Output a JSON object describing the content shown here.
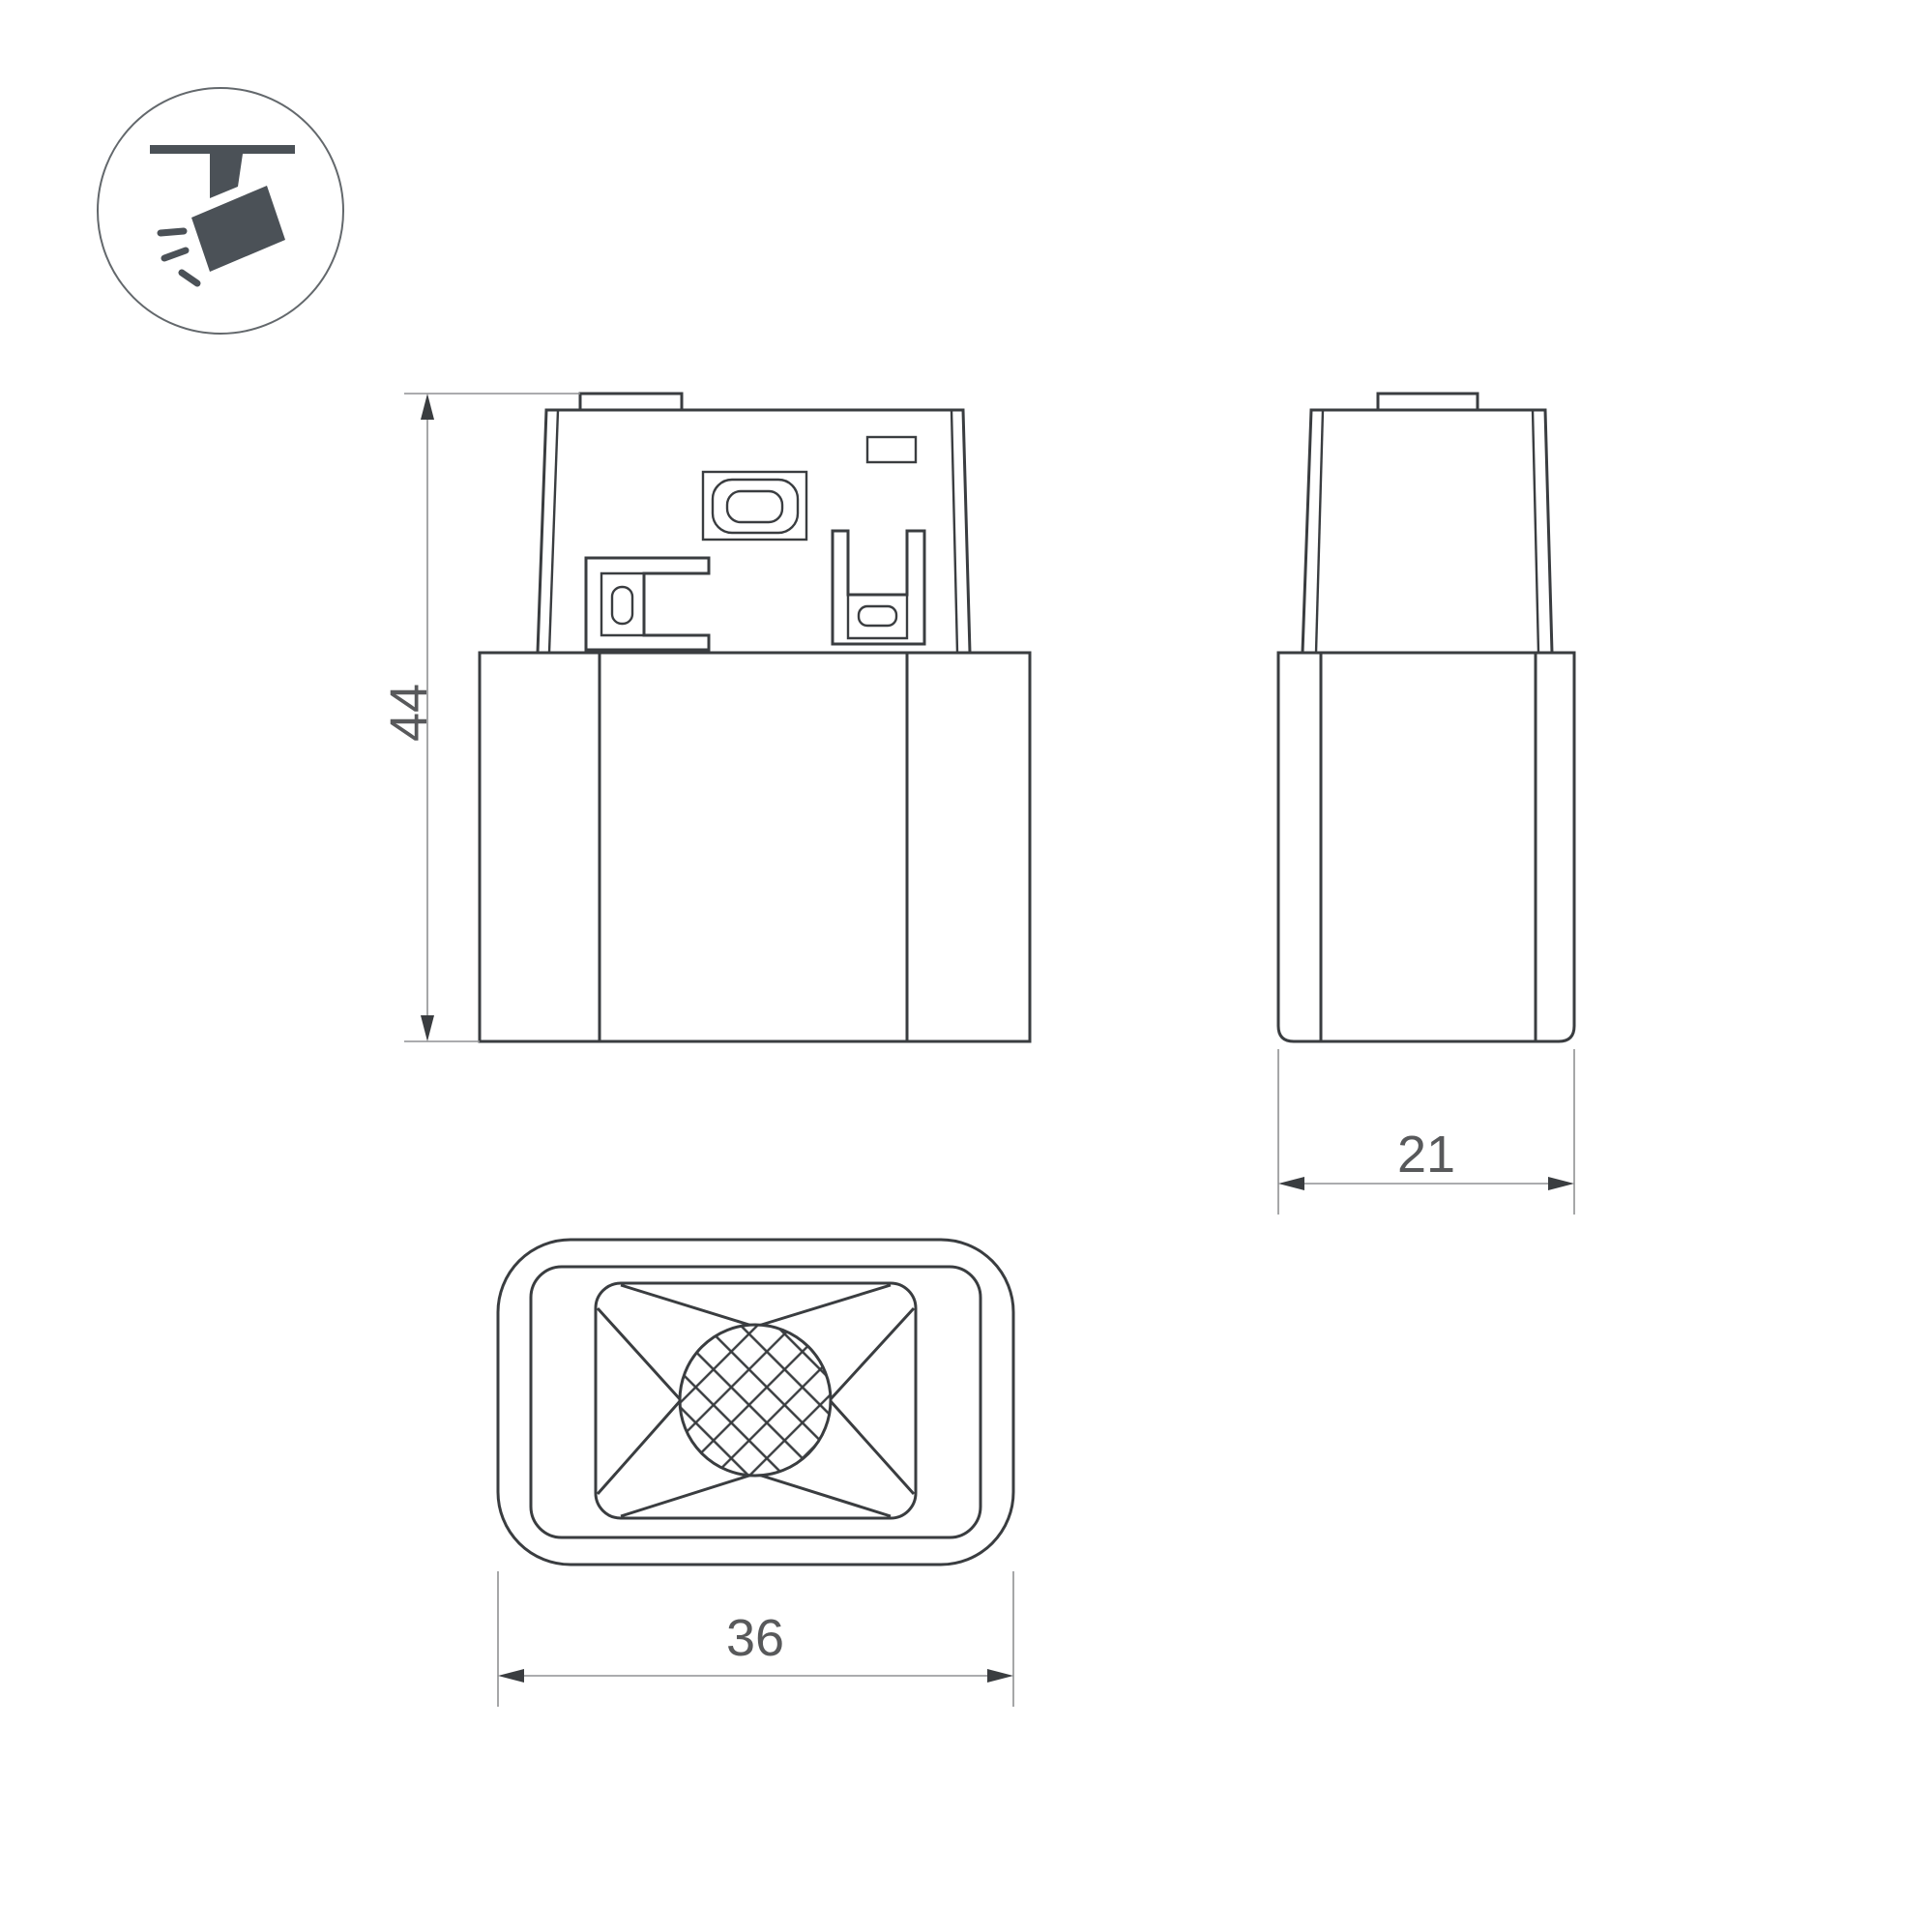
{
  "drawing": {
    "type": "technical-dimension-drawing",
    "icon": {
      "name": "track-spotlight-icon"
    },
    "views": {
      "front": {
        "name": "front-view",
        "dimension_label": "44"
      },
      "side": {
        "name": "side-view",
        "dimension_label": "21"
      },
      "bottom": {
        "name": "bottom-view",
        "dimension_label": "36"
      }
    },
    "colors": {
      "line": "#3a3d40",
      "dimension_line": "#8f9193",
      "dimension_text": "#58595b",
      "icon_fill": "#4b5157",
      "background": "#ffffff"
    }
  }
}
